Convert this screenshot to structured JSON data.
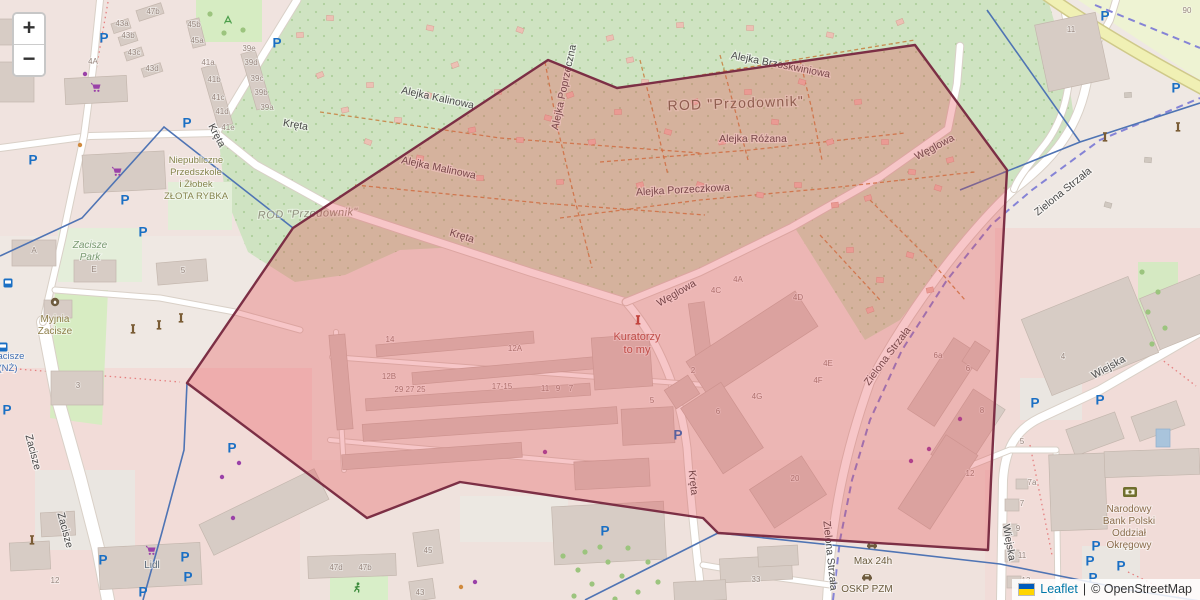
{
  "ui": {
    "zoom_in_label": "+",
    "zoom_out_label": "−",
    "attribution": {
      "leaflet": "Leaflet",
      "separator": "|",
      "copyright": "© OpenStreetMap"
    }
  },
  "colors": {
    "overlay_fill": "rgba(227,66,74,0.30)",
    "overlay_stroke": "#7c2f45",
    "green_allotment": "#cfe3c2",
    "park_green": "#d6ecc2",
    "city_pink": "#f2dcd8",
    "road_white": "#ffffff",
    "yellow_road": "#f0f0b4",
    "rail_purple": "#8583d6",
    "admin_blue": "#4f74b4",
    "building_gray": "#d7ccc5",
    "street_label": "#4a4a4a",
    "house_number": "#97867e",
    "parking_blue": "#1a6fc4",
    "shop_purple": "#9a41a8"
  },
  "labels": {
    "street": [
      {
        "text": "Kręta",
        "x": 214,
        "y": 137,
        "rot": 62
      },
      {
        "text": "Kręta",
        "x": 295,
        "y": 128,
        "rot": 10
      },
      {
        "text": "Kręta",
        "x": 461,
        "y": 239,
        "rot": 17
      },
      {
        "text": "Kręta",
        "x": 690,
        "y": 483,
        "rot": 84
      },
      {
        "text": "Węglowa",
        "x": 678,
        "y": 296,
        "rot": -30
      },
      {
        "text": "Węglowa",
        "x": 936,
        "y": 150,
        "rot": -28
      },
      {
        "text": "Alejka Kalinowa",
        "x": 437,
        "y": 101,
        "rot": 12
      },
      {
        "text": "Alejka Malinowa",
        "x": 438,
        "y": 171,
        "rot": 12
      },
      {
        "text": "Alejka Poprzeczna",
        "x": 567,
        "y": 88,
        "rot": -78
      },
      {
        "text": "Alejka Różana",
        "x": 753,
        "y": 142,
        "rot": 0
      },
      {
        "text": "Alejka Porzeczkowa",
        "x": 683,
        "y": 193,
        "rot": -3
      },
      {
        "text": "Alejka Brzoskwiniowa",
        "x": 780,
        "y": 68,
        "rot": 11
      },
      {
        "text": "Zielona Strzała",
        "x": 890,
        "y": 358,
        "rot": -53
      },
      {
        "text": "Zielona Strzała",
        "x": 1065,
        "y": 194,
        "rot": -39
      },
      {
        "text": "Zielona Strzała",
        "x": 827,
        "y": 556,
        "rot": 84
      },
      {
        "text": "Wiejska",
        "x": 1110,
        "y": 370,
        "rot": -29
      },
      {
        "text": "Wiejska",
        "x": 1006,
        "y": 543,
        "rot": 80
      },
      {
        "text": "Zacisze",
        "x": 30,
        "y": 453,
        "rot": 75
      },
      {
        "text": "Zacisze",
        "x": 62,
        "y": 531,
        "rot": 75
      }
    ],
    "house": [
      {
        "t": "47b",
        "x": 153,
        "y": 14
      },
      {
        "t": "43a",
        "x": 122,
        "y": 26
      },
      {
        "t": "43b",
        "x": 128,
        "y": 38
      },
      {
        "t": "43c",
        "x": 134,
        "y": 55
      },
      {
        "t": "43d",
        "x": 152,
        "y": 71
      },
      {
        "t": "45b",
        "x": 194,
        "y": 27
      },
      {
        "t": "45a",
        "x": 197,
        "y": 43
      },
      {
        "t": "41a",
        "x": 208,
        "y": 65
      },
      {
        "t": "41b",
        "x": 214,
        "y": 82
      },
      {
        "t": "41c",
        "x": 218,
        "y": 100
      },
      {
        "t": "41d",
        "x": 222,
        "y": 114
      },
      {
        "t": "41e",
        "x": 228,
        "y": 130
      },
      {
        "t": "39e",
        "x": 249,
        "y": 51
      },
      {
        "t": "39d",
        "x": 251,
        "y": 65
      },
      {
        "t": "39c",
        "x": 257,
        "y": 81
      },
      {
        "t": "39b",
        "x": 261,
        "y": 95
      },
      {
        "t": "39a",
        "x": 267,
        "y": 110
      },
      {
        "t": "4A",
        "x": 93,
        "y": 64
      },
      {
        "t": "A",
        "x": 34,
        "y": 253
      },
      {
        "t": "E",
        "x": 94,
        "y": 272
      },
      {
        "t": "5",
        "x": 183,
        "y": 273
      },
      {
        "t": "3",
        "x": 78,
        "y": 388
      },
      {
        "t": "12",
        "x": 55,
        "y": 583
      },
      {
        "t": "47d",
        "x": 336,
        "y": 570
      },
      {
        "t": "47b",
        "x": 365,
        "y": 570
      },
      {
        "t": "45",
        "x": 428,
        "y": 553
      },
      {
        "t": "43",
        "x": 420,
        "y": 595
      },
      {
        "t": "33",
        "x": 756,
        "y": 582
      },
      {
        "t": "14",
        "x": 390,
        "y": 342
      },
      {
        "t": "12A",
        "x": 515,
        "y": 351
      },
      {
        "t": "12B",
        "x": 389,
        "y": 379
      },
      {
        "t": "29 27 25",
        "x": 410,
        "y": 392
      },
      {
        "t": "17-15",
        "x": 502,
        "y": 389
      },
      {
        "t": "11",
        "x": 545,
        "y": 391
      },
      {
        "t": "9",
        "x": 558,
        "y": 391
      },
      {
        "t": "7",
        "x": 571,
        "y": 391
      },
      {
        "t": "5",
        "x": 652,
        "y": 403
      },
      {
        "t": "2",
        "x": 693,
        "y": 373
      },
      {
        "t": "6",
        "x": 718,
        "y": 414
      },
      {
        "t": "4A",
        "x": 738,
        "y": 282
      },
      {
        "t": "4C",
        "x": 716,
        "y": 293
      },
      {
        "t": "4D",
        "x": 798,
        "y": 300
      },
      {
        "t": "4E",
        "x": 828,
        "y": 366
      },
      {
        "t": "4F",
        "x": 818,
        "y": 383
      },
      {
        "t": "4G",
        "x": 757,
        "y": 399
      },
      {
        "t": "20",
        "x": 795,
        "y": 481
      },
      {
        "t": "6a",
        "x": 938,
        "y": 358
      },
      {
        "t": "6",
        "x": 968,
        "y": 371
      },
      {
        "t": "8",
        "x": 982,
        "y": 413
      },
      {
        "t": "12",
        "x": 970,
        "y": 476
      },
      {
        "t": "5",
        "x": 1022,
        "y": 444
      },
      {
        "t": "7a",
        "x": 1032,
        "y": 485
      },
      {
        "t": "7",
        "x": 1022,
        "y": 506
      },
      {
        "t": "9",
        "x": 1018,
        "y": 531
      },
      {
        "t": "11",
        "x": 1022,
        "y": 558
      },
      {
        "t": "13",
        "x": 1026,
        "y": 583
      },
      {
        "t": "4",
        "x": 1063,
        "y": 359
      },
      {
        "t": "11",
        "x": 1071,
        "y": 32
      },
      {
        "t": "90",
        "x": 1187,
        "y": 13
      }
    ],
    "area": [
      {
        "text": "ROD \"Przodownik\"",
        "x": 736,
        "y": 108,
        "size": 14,
        "color": "#6a6a52",
        "rot": -2,
        "italic": false,
        "spacing": 1.2
      },
      {
        "text": "ROD \"Przodownik\"",
        "x": 308,
        "y": 217,
        "size": 11,
        "color": "#90907e",
        "rot": -2,
        "italic": true,
        "spacing": 0.5
      }
    ],
    "poi": [
      {
        "id": "przedszkole",
        "lines": [
          "Niepubliczne",
          "Przedszkole",
          "i Żłobek",
          "ZŁOTA RYBKA"
        ],
        "x": 196,
        "y": 163,
        "dy": 12,
        "color": "#85854d",
        "size": 9.5,
        "italic": false
      },
      {
        "id": "zacisze-park",
        "lines": [
          "Zacisze",
          "Park"
        ],
        "x": 90,
        "y": 248,
        "dy": 12,
        "color": "#7a9a72",
        "size": 10,
        "italic": true
      },
      {
        "id": "myjnia-zacisze",
        "lines": [
          "Myjnia",
          "Zacisze"
        ],
        "x": 55,
        "y": 322,
        "dy": 12,
        "color": "#8d7d48",
        "size": 10,
        "italic": false
      },
      {
        "id": "kuratorzy",
        "lines": [
          "Kuratorzy",
          "to my"
        ],
        "x": 637,
        "y": 340,
        "dy": 13,
        "color": "#b0544a",
        "size": 11,
        "italic": false
      },
      {
        "id": "bank",
        "lines": [
          "Narodowy",
          "Bank Polski",
          "Oddział",
          "Okręgowy"
        ],
        "x": 1129,
        "y": 512,
        "dy": 12,
        "color": "#8a6d4c",
        "size": 10,
        "italic": false
      },
      {
        "id": "max-24h",
        "lines": [
          "Max 24h"
        ],
        "x": 873,
        "y": 564,
        "dy": 12,
        "color": "#6b5c3e",
        "size": 10,
        "italic": false
      },
      {
        "id": "oskp-pzm",
        "lines": [
          "OSKP PZM"
        ],
        "x": 867,
        "y": 592,
        "dy": 12,
        "color": "#6b5c3e",
        "size": 10,
        "italic": false
      },
      {
        "id": "lidl",
        "lines": [
          "Lidl"
        ],
        "x": 152,
        "y": 568,
        "dy": 12,
        "color": "#5c6c7c",
        "size": 10,
        "italic": false
      },
      {
        "id": "zacisze-nz",
        "lines": [
          "Zacisze",
          "(NŻ)"
        ],
        "x": 8,
        "y": 359,
        "dy": 12,
        "color": "#4070b4",
        "size": 9.5,
        "italic": false
      }
    ]
  },
  "icons": {
    "parking": [
      [
        104,
        38
      ],
      [
        277,
        43
      ],
      [
        33,
        160
      ],
      [
        187,
        123
      ],
      [
        125,
        200
      ],
      [
        143,
        232
      ],
      [
        7,
        410
      ],
      [
        232,
        448
      ],
      [
        103,
        560
      ],
      [
        185,
        557
      ],
      [
        188,
        577
      ],
      [
        143,
        592
      ],
      [
        678,
        435
      ],
      [
        605,
        531
      ],
      [
        1035,
        403
      ],
      [
        1100,
        400
      ],
      [
        1096,
        546
      ],
      [
        1090,
        561
      ],
      [
        1093,
        578
      ],
      [
        1121,
        566
      ],
      [
        1176,
        88
      ],
      [
        1105,
        16
      ]
    ],
    "cart": [
      [
        97,
        88
      ],
      [
        118,
        172
      ],
      [
        152,
        551
      ]
    ],
    "monument": [
      [
        133,
        330
      ],
      [
        159,
        326
      ],
      [
        181,
        319
      ],
      [
        32,
        541
      ],
      [
        1105,
        138
      ],
      [
        1178,
        128
      ]
    ],
    "monument-red": [
      [
        638,
        321
      ]
    ],
    "bus": [
      [
        8,
        283
      ],
      [
        3,
        347
      ]
    ],
    "bank": [
      [
        1130,
        492
      ]
    ],
    "car": [
      [
        872,
        545
      ],
      [
        867,
        577
      ]
    ],
    "carwash": [
      [
        55,
        302
      ]
    ],
    "runner": [
      [
        357,
        588
      ]
    ],
    "playground": [
      [
        228,
        20
      ]
    ],
    "dot-purple": [
      [
        85,
        74
      ],
      [
        239,
        463
      ],
      [
        222,
        477
      ],
      [
        233,
        518
      ],
      [
        960,
        419
      ],
      [
        929,
        449
      ],
      [
        911,
        461
      ],
      [
        475,
        582
      ],
      [
        545,
        452
      ]
    ],
    "dot-orange": [
      [
        80,
        145
      ],
      [
        461,
        587
      ]
    ]
  },
  "trees": [
    [
      563,
      556
    ],
    [
      578,
      570
    ],
    [
      592,
      584
    ],
    [
      608,
      562
    ],
    [
      574,
      596
    ],
    [
      622,
      576
    ],
    [
      638,
      592
    ],
    [
      648,
      562
    ],
    [
      600,
      547
    ],
    [
      628,
      548
    ],
    [
      658,
      582
    ],
    [
      615,
      599
    ],
    [
      585,
      552
    ],
    [
      1142,
      272
    ],
    [
      1158,
      292
    ],
    [
      1148,
      312
    ],
    [
      1165,
      328
    ],
    [
      1152,
      344
    ],
    [
      210,
      14
    ],
    [
      243,
      30
    ],
    [
      224,
      33
    ]
  ]
}
